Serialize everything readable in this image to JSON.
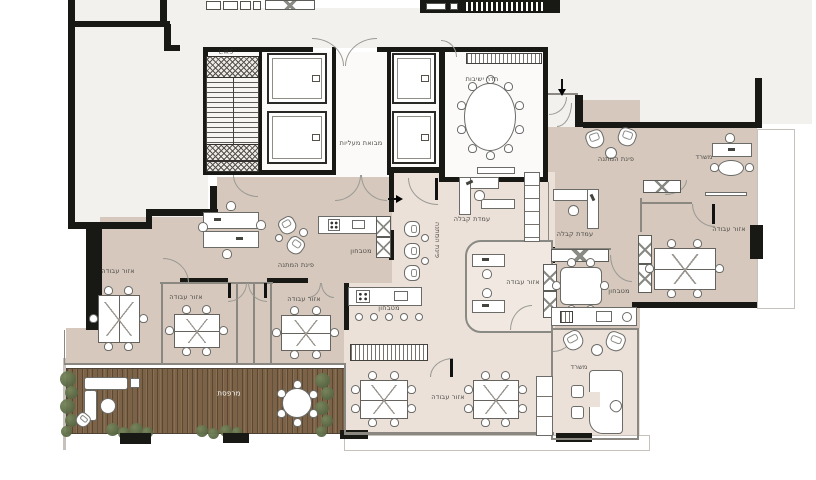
{
  "plan": {
    "type": "architectural-floor-plan",
    "language": "Hebrew",
    "colors": {
      "wall": "#181815",
      "floor_tan": "#d6c8bc",
      "floor_pale": "#ece1d9",
      "floor_white": "#fbfaf8",
      "shell": "#f2f1ee",
      "deck_wood": "#7c6347",
      "plant_green": "#5d6c48",
      "label_text": "#4a4a46"
    }
  },
  "rooms": [
    {
      "id": "meeting-room",
      "label": "חדר ישיבות"
    },
    {
      "id": "elevator-lobby",
      "label": "מבואת מעליות"
    },
    {
      "id": "waiting-corner-east",
      "label": "פינת המתנה"
    },
    {
      "id": "office-northeast",
      "label": "משרד"
    },
    {
      "id": "reception-1",
      "label": "עמדת קבלה"
    },
    {
      "id": "reception-2",
      "label": "עמדת קבלה"
    },
    {
      "id": "waiting-corner-reception",
      "label": "פינת המתנה"
    },
    {
      "id": "waiting-corner-center",
      "label": "פינת המתנה"
    },
    {
      "id": "kitchenette-north",
      "label": "מטבחון"
    },
    {
      "id": "work-area-west",
      "label": "אזור עבודה"
    },
    {
      "id": "work-area-southwest",
      "label": "אזור עבודה"
    },
    {
      "id": "work-area-center",
      "label": "אזור עבודה"
    },
    {
      "id": "work-area-mid",
      "label": "אזור עבודה"
    },
    {
      "id": "work-area-east",
      "label": "אזור עבודה"
    },
    {
      "id": "kitchenette-bar",
      "label": "מטבחון"
    },
    {
      "id": "kitchenette-east",
      "label": "מטבחון"
    },
    {
      "id": "office-southeast",
      "label": "משרד"
    },
    {
      "id": "work-area-south",
      "label": "אזור עבודה"
    },
    {
      "id": "terrace",
      "label": "מרפסת"
    },
    {
      "id": "stairwell",
      "label": "L.W.S"
    }
  ]
}
